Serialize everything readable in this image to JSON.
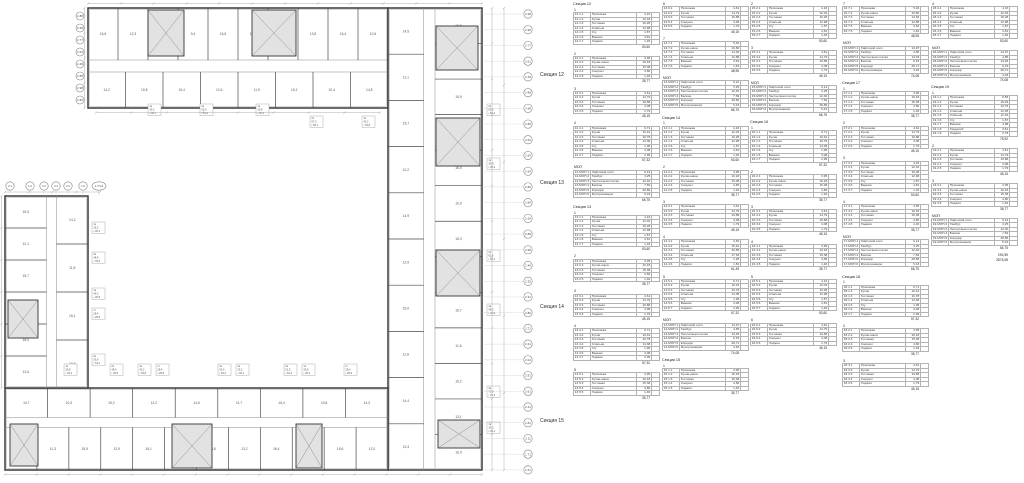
{
  "plan": {
    "section_labels": [
      {
        "label": "Секция 12",
        "y": 75
      },
      {
        "label": "Секция 13",
        "y": 183
      },
      {
        "label": "Секция 14",
        "y": 307
      },
      {
        "label": "Секция 15",
        "y": 421
      }
    ],
    "bands": [
      {
        "id": "top",
        "side": "n",
        "x": 88,
        "y": 8,
        "w": 300,
        "h": 100,
        "outer": {
          "n": 10,
          "labels": [
            "16,6",
            "12,3",
            "16,1",
            "9,4",
            "16,5",
            "11,2",
            "16,2",
            "13,8",
            "16,4",
            "10,6"
          ]
        },
        "inner": {
          "n": 8,
          "labels": [
            "14,2",
            "10,8",
            "15,4",
            "12,6",
            "11,9",
            "15,1",
            "10,4",
            "14,8"
          ]
        }
      },
      {
        "id": "right",
        "side": "e",
        "x": 388,
        "y": 8,
        "w": 94,
        "h": 462,
        "outer": {
          "n": 13,
          "labels": [
            "16,8",
            "11,4",
            "15,9",
            "12,7",
            "16,0",
            "10,9",
            "15,3",
            "12,4",
            "16,7",
            "11,6",
            "15,2",
            "13,1",
            "16,9"
          ]
        },
        "inner": {
          "n": 10,
          "labels": [
            "14,5",
            "11,1",
            "15,7",
            "10,2",
            "14,9",
            "12,9",
            "15,0",
            "11,8",
            "14,4",
            "13,3"
          ]
        }
      },
      {
        "id": "bottom",
        "side": "s",
        "x": 5,
        "y": 388,
        "w": 383,
        "h": 82,
        "outer": {
          "n": 12,
          "labels": [
            "16,2",
            "11,3",
            "15,5",
            "12,5",
            "16,1",
            "10,7",
            "15,8",
            "13,2",
            "16,4",
            "11,9",
            "15,6",
            "12,0"
          ]
        },
        "inner": {
          "n": 9,
          "labels": [
            "14,7",
            "10,3",
            "15,2",
            "12,2",
            "14,6",
            "11,7",
            "15,4",
            "10,8",
            "14,3"
          ]
        }
      },
      {
        "id": "left",
        "side": "w",
        "x": 5,
        "y": 196,
        "w": 83,
        "h": 192,
        "outer": {
          "n": 6,
          "labels": [
            "16,5",
            "12,1",
            "15,7",
            "11,2",
            "16,0",
            "12,6"
          ]
        },
        "inner": {
          "n": 4,
          "labels": [
            "14,2",
            "11,5",
            "15,1",
            "10,9"
          ]
        }
      }
    ],
    "cores": [
      [
        148,
        10,
        36,
        46
      ],
      [
        252,
        10,
        44,
        46
      ],
      [
        436,
        26,
        42,
        44
      ],
      [
        436,
        118,
        44,
        48
      ],
      [
        436,
        250,
        44,
        46
      ],
      [
        438,
        420,
        42,
        28
      ],
      [
        172,
        424,
        40,
        44
      ],
      [
        296,
        424,
        26,
        44
      ],
      [
        10,
        424,
        28,
        42
      ],
      [
        8,
        300,
        30,
        38
      ]
    ],
    "stamps": [
      [
        148,
        104,
        "1к",
        "35,2",
        "36,1"
      ],
      [
        200,
        104,
        "2к",
        "53,6",
        "54,2"
      ],
      [
        256,
        104,
        "1к",
        "35,8",
        "36,3"
      ],
      [
        310,
        116,
        "2к",
        "57,3",
        "58,1"
      ],
      [
        362,
        116,
        "1к",
        "45,2",
        "45,8"
      ],
      [
        487,
        104,
        "2к",
        "53,6",
        "54,2"
      ],
      [
        487,
        158,
        "1к",
        "35,8",
        "36,3"
      ],
      [
        487,
        250,
        "2к",
        "61,5",
        "62,2"
      ],
      [
        487,
        304,
        "1к",
        "45,2",
        "45,8"
      ],
      [
        487,
        386,
        "3к",
        "75,9",
        "76,4"
      ],
      [
        487,
        422,
        "1к",
        "35,2",
        "36,1"
      ],
      [
        64,
        364,
        "1к",
        "35,8",
        "36,3"
      ],
      [
        110,
        364,
        "2к",
        "48,9",
        "49,5"
      ],
      [
        138,
        364,
        "1к",
        "45,2",
        "45,8"
      ],
      [
        156,
        364,
        "ст",
        "28,4",
        "28,9"
      ],
      [
        218,
        364,
        "2к",
        "53,6",
        "54,2"
      ],
      [
        236,
        364,
        "1к",
        "35,2",
        "36,1"
      ],
      [
        284,
        364,
        "2к",
        "61,5",
        "62,2"
      ],
      [
        302,
        364,
        "1к",
        "35,8",
        "36,3"
      ],
      [
        344,
        364,
        "ст",
        "28,4",
        "28,9"
      ],
      [
        92,
        222,
        "1к",
        "35,2",
        "36,1"
      ],
      [
        92,
        252,
        "2к",
        "48,9",
        "49,5"
      ],
      [
        92,
        288,
        "1к",
        "45,2",
        "45,8"
      ],
      [
        92,
        308,
        "ст",
        "28,4",
        "28,9"
      ],
      [
        92,
        354,
        "2к",
        "53,6",
        "54,2"
      ]
    ],
    "grid_right": {
      "x": 528,
      "y0": 14,
      "dy": 15.72,
      "values": [
        "2.68",
        "2.99",
        "2.77",
        "2.61",
        "2.49",
        "2.88",
        "2.98",
        "2.89",
        "2.64",
        "2.65",
        "2.60",
        "2.80",
        "2.84",
        "2.64",
        "2.88",
        "2.98",
        "2.46",
        "2.35",
        "2.31",
        "2.80",
        "2.71",
        "2.21",
        "2.02",
        "2.91",
        "2.61",
        "2.41",
        "2.81",
        "2.11",
        "1.71",
        "1.61"
      ]
    },
    "grid_top_left": {
      "x": 80,
      "y0": 16,
      "dy": 12,
      "values": [
        "2.88",
        "2.99",
        "2.77",
        "2.61",
        "2.49",
        "2.85",
        "2.98",
        "2.82"
      ]
    },
    "grid_wing_top": {
      "y": 186,
      "items": [
        [
          10,
          "2.1"
        ],
        [
          30,
          "1.2"
        ],
        [
          44,
          "1.5"
        ],
        [
          56,
          "2.4"
        ],
        [
          68,
          "2.3"
        ],
        [
          83,
          "1.6"
        ],
        [
          99,
          "1.7/1.8"
        ]
      ]
    }
  },
  "tables": {
    "room_sets": {
      "T7": {
        "rows": [
          [
            "Прихожая",
            "4,16"
          ],
          [
            "Кухня",
            "12,04"
          ],
          [
            "Гостиная",
            "16,28"
          ],
          [
            "Спальня",
            "12,98"
          ],
          [
            "С/у",
            "1,87"
          ],
          [
            "Ванная",
            "4,81"
          ],
          [
            "Лоджия",
            "1,46"
          ]
        ],
        "t": "53,60"
      },
      "T7b": {
        "rows": [
          [
            "Прихожая",
            "6,71"
          ],
          [
            "Кухня",
            "10,42"
          ],
          [
            "Гостиная",
            "16,78"
          ],
          [
            "Спальня",
            "14,38"
          ],
          [
            "С/у",
            "1,96"
          ],
          [
            "Ванная",
            "4,08"
          ],
          [
            "Лоджия",
            "2,99"
          ]
        ],
        "t": "57,32"
      },
      "T5": {
        "rows": [
          [
            "Прихожая",
            "3,95"
          ],
          [
            "Кухня-ниша",
            "10,18"
          ],
          [
            "Гостиная",
            "15,38"
          ],
          [
            "Санузел",
            "4,80"
          ],
          [
            "Лоджия",
            "1,46"
          ]
        ],
        "t": "35,77"
      },
      "T5b": {
        "rows": [
          [
            "Прихожая",
            "4,61"
          ],
          [
            "Кухня",
            "14,79"
          ],
          [
            "Гостиная",
            "19,88"
          ],
          [
            "Санузел",
            "4,08"
          ],
          [
            "Лоджия",
            "1,79"
          ]
        ],
        "t": "45,15"
      },
      "T6": {
        "rows": [
          [
            "Прихожая",
            "5,46"
          ],
          [
            "Кухня-ниша",
            "10,80"
          ],
          [
            "Гостиная",
            "14,36"
          ],
          [
            "Спальня",
            "12,88"
          ],
          [
            "Ванная",
            "3,64"
          ],
          [
            "Лоджия",
            "1,81"
          ]
        ],
        "t": "48,95"
      },
      "T6b": {
        "rows": [
          [
            "Прихожая",
            "4,52"
          ],
          [
            "Кухня",
            "15,42"
          ],
          [
            "Гостиная",
            "20,89"
          ],
          [
            "Спальня",
            "17,18"
          ],
          [
            "С/у",
            "1,96"
          ],
          [
            "Лоджия",
            "1,52"
          ]
        ],
        "t": "61,49"
      },
      "T9": {
        "rows": [
          [
            "Прихожая",
            "8,55"
          ],
          [
            "Кухня",
            "16,49"
          ],
          [
            "Гостиная",
            "13,75"
          ],
          [
            "Спальня",
            "12,05"
          ],
          [
            "Спальня",
            "11,94"
          ],
          [
            "С/у",
            "1,87"
          ],
          [
            "Ванная",
            "4,88"
          ],
          [
            "Гардероб",
            "3,61"
          ],
          [
            "Лоджия",
            "2,78"
          ]
        ],
        "t": "75,92"
      },
      "MA": {
        "rows": [
          [
            "Лифтовой холл",
            "9,12"
          ],
          [
            "Тамбур",
            "3,25"
          ],
          [
            "Лестничная клетка",
            "12,40"
          ],
          [
            "Балкон",
            "7,69"
          ],
          [
            "Коридор",
            "28,86"
          ],
          [
            "Мусорокамера",
            "5,43"
          ]
        ],
        "t": "66,75"
      },
      "MB": {
        "rows": [
          [
            "Лифтовой холл",
            "14,97"
          ],
          [
            "Тамбур",
            "4,86"
          ],
          [
            "Лестничная клетка",
            "13,45"
          ],
          [
            "Балкон",
            "6,15"
          ],
          [
            "Коридор",
            "29,71"
          ],
          [
            "Мусорокамера",
            "4,94"
          ]
        ],
        "t": "74,08"
      }
    },
    "columns": [
      {
        "x": 573,
        "blocks": [
          {
            "sec": "Секция 12"
          },
          {
            "n": "1",
            "c": "12.1",
            "s": "T7"
          },
          {
            "n": "2",
            "c": "12.2",
            "s": "T5"
          },
          {
            "n": "3",
            "c": "12.3",
            "s": "T5b"
          },
          {
            "n": "4",
            "c": "12.4",
            "s": "T7b"
          },
          {
            "n": "МОП",
            "c": "12-МОП",
            "s": "MA"
          },
          {
            "sec": "Секция 13"
          },
          {
            "n": "1",
            "c": "13.1",
            "s": "T7"
          },
          {
            "n": "2",
            "c": "13.2",
            "s": "T5"
          },
          {
            "n": "3",
            "c": "13.3",
            "s": "T5b"
          },
          {
            "n": "4",
            "c": "13.4",
            "s": "T7b"
          },
          {
            "n": "5",
            "c": "13.5",
            "s": "T5"
          }
        ]
      },
      {
        "x": 662,
        "blocks": [
          {
            "n": "6",
            "c": "13.6",
            "s": "T5b"
          },
          {
            "n": "7",
            "c": "13.7",
            "s": "T6"
          },
          {
            "n": "МОП",
            "c": "13-МОП",
            "s": "MA"
          },
          {
            "sec": "Секция 14"
          },
          {
            "n": "1",
            "c": "14.1",
            "s": "T7"
          },
          {
            "n": "2",
            "c": "14.2",
            "s": "T5"
          },
          {
            "n": "3",
            "c": "14.3",
            "s": "T5b"
          },
          {
            "n": "4",
            "c": "14.4",
            "s": "T6b"
          },
          {
            "n": "5",
            "c": "14.5",
            "s": "T7b"
          },
          {
            "n": "МОП",
            "c": "14-МОП",
            "s": "MB"
          },
          {
            "sec": "Секция 15"
          },
          {
            "n": "1",
            "c": "15.1",
            "s": "T5"
          }
        ]
      },
      {
        "x": 750,
        "blocks": [
          {
            "n": "2",
            "c": "15.2",
            "s": "T7"
          },
          {
            "n": "3",
            "c": "15.3",
            "s": "T5b"
          },
          {
            "n": "МОП",
            "c": "15-МОП",
            "s": "MA"
          },
          {
            "sec": "Секция 16"
          },
          {
            "n": "1",
            "c": "16.1",
            "s": "T7b"
          },
          {
            "n": "2",
            "c": "16.2",
            "s": "T5"
          },
          {
            "n": "3",
            "c": "16.3",
            "s": "T5b"
          },
          {
            "n": "4",
            "c": "16.4",
            "s": "T5"
          },
          {
            "n": "5",
            "c": "16.5",
            "s": "T7"
          },
          {
            "n": "6",
            "c": "16.6",
            "s": "T5b"
          }
        ]
      },
      {
        "x": 842,
        "blocks": [
          {
            "n": "7",
            "c": "16.7",
            "s": "T6"
          },
          {
            "n": "МОП",
            "c": "16-МОП",
            "s": "MB"
          },
          {
            "sec": "Секция 17"
          },
          {
            "n": "1",
            "c": "17.1",
            "s": "T5"
          },
          {
            "n": "2",
            "c": "17.2",
            "s": "T5b"
          },
          {
            "n": "3",
            "c": "17.3",
            "s": "T7"
          },
          {
            "n": "4",
            "c": "17.4",
            "s": "T5"
          },
          {
            "n": "МОП",
            "c": "17-МОП",
            "s": "MA"
          },
          {
            "sec": "Секция 18"
          },
          {
            "n": "1",
            "c": "18.1",
            "s": "T7b"
          },
          {
            "n": "2",
            "c": "18.2",
            "s": "T5"
          },
          {
            "n": "3",
            "c": "18.3",
            "s": "T5b"
          }
        ]
      },
      {
        "x": 931,
        "blocks": [
          {
            "n": "4",
            "c": "18.4",
            "s": "T7"
          },
          {
            "n": "МОП",
            "c": "18-МОП",
            "s": "MB"
          },
          {
            "sec": "Секция 19"
          },
          {
            "n": "1",
            "c": "19.1",
            "s": "T9"
          },
          {
            "n": "2",
            "c": "19.2",
            "s": "T5b"
          },
          {
            "n": "3",
            "c": "19.3",
            "s": "T5"
          },
          {
            "n": "МОП",
            "c": "19-МОП",
            "s": "MA"
          },
          {
            "grand": [
              "292,59",
              "2875,08"
            ]
          }
        ]
      }
    ]
  }
}
